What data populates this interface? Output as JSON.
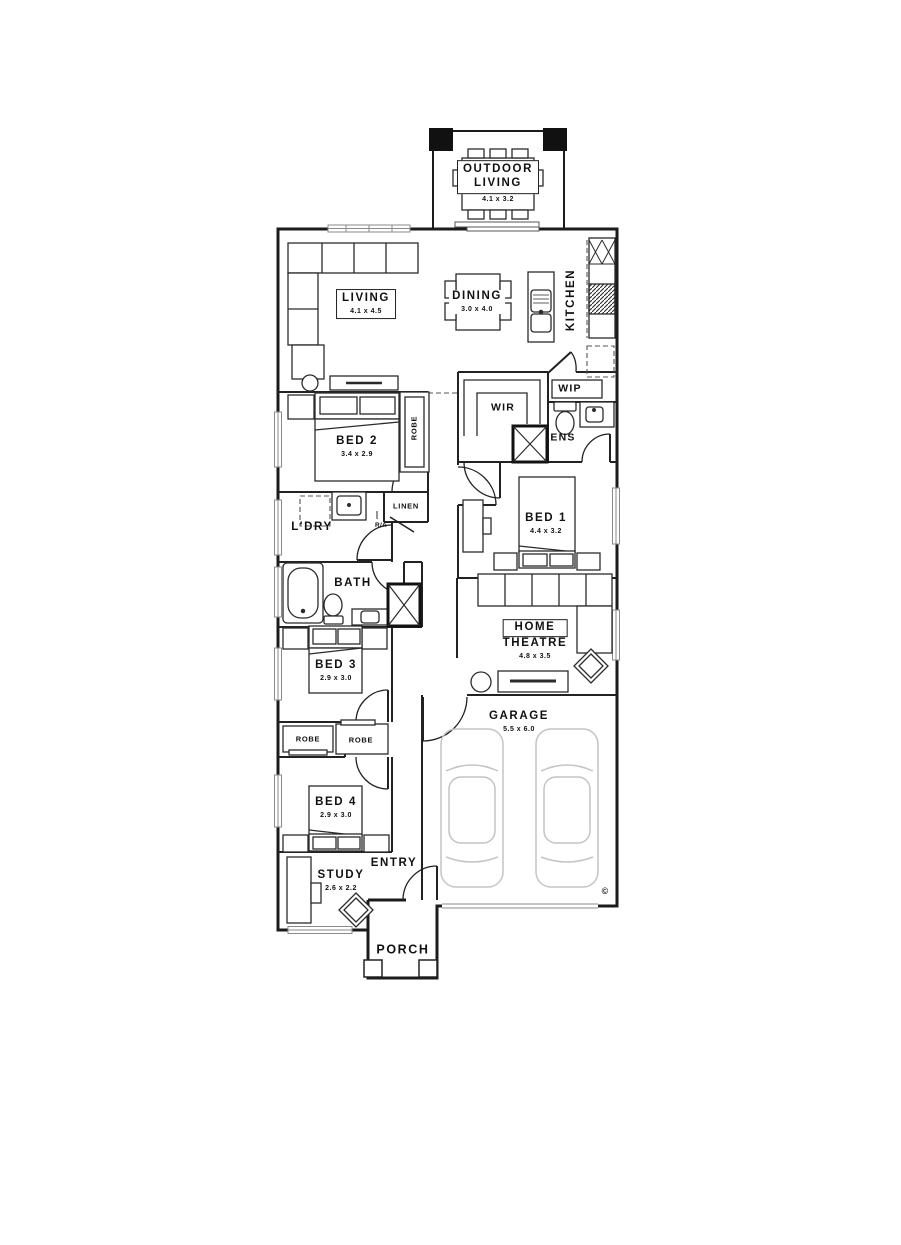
{
  "rooms": {
    "outdoor_living": {
      "name1": "OUTDOOR",
      "name2": "LIVING",
      "dim": "4.1 x 3.2"
    },
    "living": {
      "name": "LIVING",
      "dim": "4.1 x 4.5"
    },
    "dining": {
      "name": "DINING",
      "dim": "3.0 x 4.0"
    },
    "kitchen": {
      "name": "KITCHEN"
    },
    "wip": {
      "name": "WIP"
    },
    "wir": {
      "name": "WIR"
    },
    "ens": {
      "name": "ENS"
    },
    "bed2": {
      "name": "BED 2",
      "dim": "3.4 x 2.9"
    },
    "robe_bed2": {
      "name": "ROBE"
    },
    "bed1": {
      "name": "BED 1",
      "dim": "4.4 x 3.2"
    },
    "ldry": {
      "name": "L'DRY"
    },
    "linen": {
      "name": "LINEN"
    },
    "return_air": {
      "name": "R/A"
    },
    "bath": {
      "name": "BATH"
    },
    "home_theatre": {
      "name1": "HOME",
      "name2": "THEATRE",
      "dim": "4.8 x 3.5"
    },
    "bed3": {
      "name": "BED 3",
      "dim": "2.9 x 3.0"
    },
    "robe_bed3": {
      "name": "ROBE"
    },
    "robe_bed4": {
      "name": "ROBE"
    },
    "bed4": {
      "name": "BED 4",
      "dim": "2.9 x 3.0"
    },
    "garage": {
      "name": "GARAGE",
      "dim": "5.5 x 6.0"
    },
    "study": {
      "name": "STUDY",
      "dim": "2.6 x 2.2"
    },
    "entry": {
      "name": "ENTRY"
    },
    "porch": {
      "name": "PORCH"
    }
  },
  "symbols": {
    "copyright": "©"
  },
  "colors": {
    "wall": "#1b1b1b",
    "furniture": "#2b2b2b",
    "light": "#8a8a8a",
    "car": "#c4c4c4",
    "background": "#ffffff"
  }
}
